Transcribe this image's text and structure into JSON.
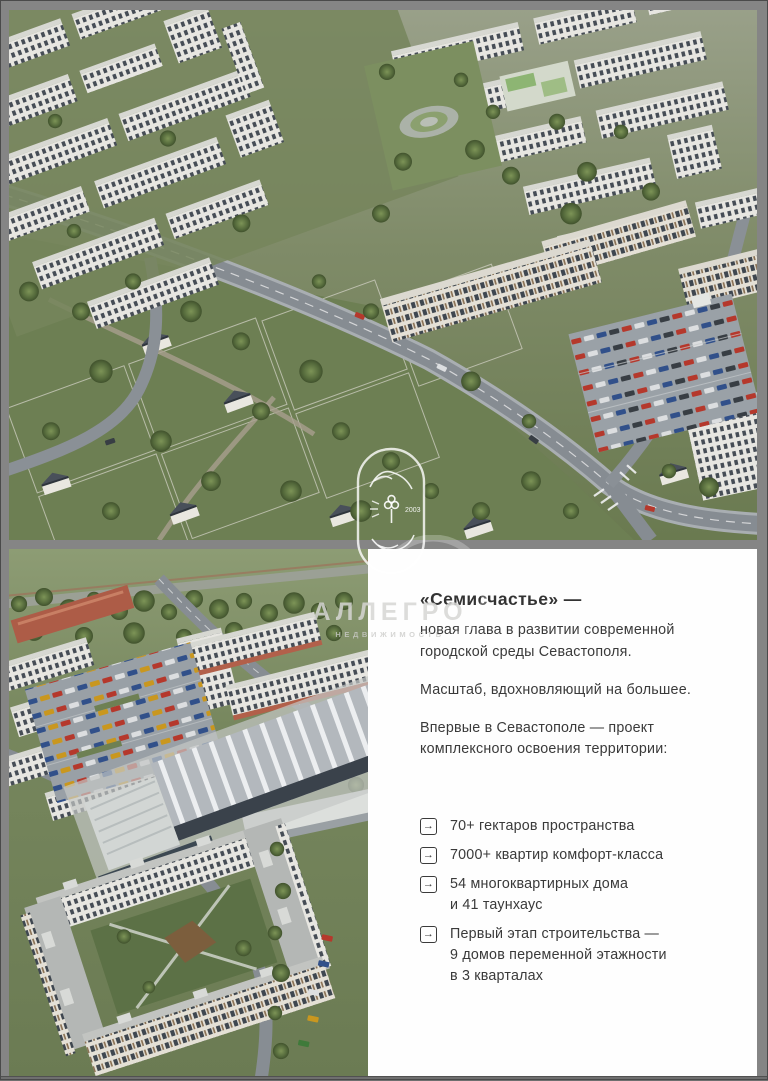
{
  "panel": {
    "heading": "«Семисчастье» —",
    "intro": "новая глава в развитии современной\nгородской среды Севастополя.",
    "scale_line": "Масштаб, вдохновляющий на большее.",
    "first_line": "Впервые в Севастополе — проект\nкомплексного освоения территории:",
    "bullet_icon": "→",
    "bullets": [
      {
        "text": "70+ гектаров пространства"
      },
      {
        "text": "7000+ квартир комфорт-класса"
      },
      {
        "text": "54 многоквартирных дома\nи 41 таунхаус"
      },
      {
        "text": "Первый этап строительства —\n9 домов переменной этажности\nв 3 кварталах"
      }
    ]
  },
  "watermark": {
    "agency": "АЛЛЕГРО",
    "subtitle": "НЕДВИЖИМОСТЬ",
    "year": "2003"
  },
  "images": {
    "top_label": "aerial-render-of-residential-district",
    "bottom_label": "aerial-render-parking-school-and-courtyard-block"
  },
  "colors": {
    "frame_gray": "#858585",
    "panel_bg": "#fefefe",
    "text": "#3a3a3a",
    "terracotta_accent": "#b2604a"
  }
}
